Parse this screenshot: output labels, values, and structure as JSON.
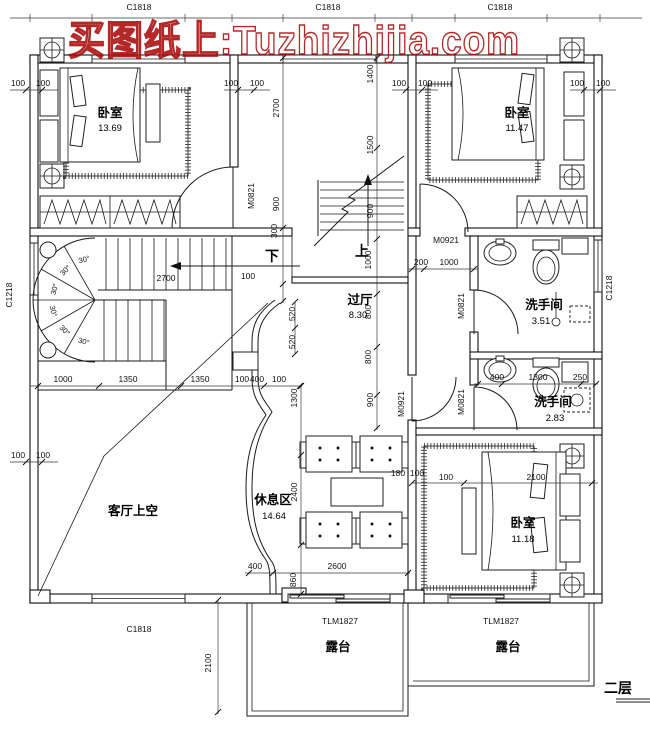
{
  "watermark": "买图纸上:Tuzhizhijia.com",
  "floor_label": "二层",
  "colors": {
    "watermark_red": "#aa0b0b",
    "line_black": "#1a1a1a"
  },
  "rooms": {
    "bedroom_tl": {
      "name": "卧室",
      "area": "13.69"
    },
    "bedroom_tr": {
      "name": "卧室",
      "area": "11.47"
    },
    "hall": {
      "name": "过厅",
      "area": "8.30"
    },
    "bath_upper": {
      "name": "洗手间",
      "area": "3.51"
    },
    "bath_lower": {
      "name": "洗手间",
      "area": "2.83"
    },
    "living_void": {
      "name": "客厅上空"
    },
    "lounge": {
      "name": "休息区",
      "area": "14.64"
    },
    "bedroom_br": {
      "name": "卧室",
      "area": "11.18"
    },
    "terrace_left": {
      "name": "露台"
    },
    "terrace_right": {
      "name": "露台"
    }
  },
  "stairs": {
    "up_label": "上",
    "down_label": "下",
    "angle_label": "30°"
  },
  "opening_tags": {
    "c1818": "C1818",
    "c1218": "C1218",
    "tlm1827": "TLM1827",
    "m0821": "M0821",
    "m0921": "M0921"
  },
  "dims": {
    "d100": "100",
    "d180": "180",
    "d200": "200",
    "d250": "250",
    "d300": "300",
    "d400": "400",
    "d520": "520",
    "d800": "800",
    "d860": "860",
    "d900": "900",
    "d1000": "1000",
    "d1300": "1300",
    "d1350": "1350",
    "d1400": "1400",
    "d1500": "1500",
    "d2100": "2100",
    "d2400": "2400",
    "d2600": "2600",
    "d2700": "2700"
  }
}
